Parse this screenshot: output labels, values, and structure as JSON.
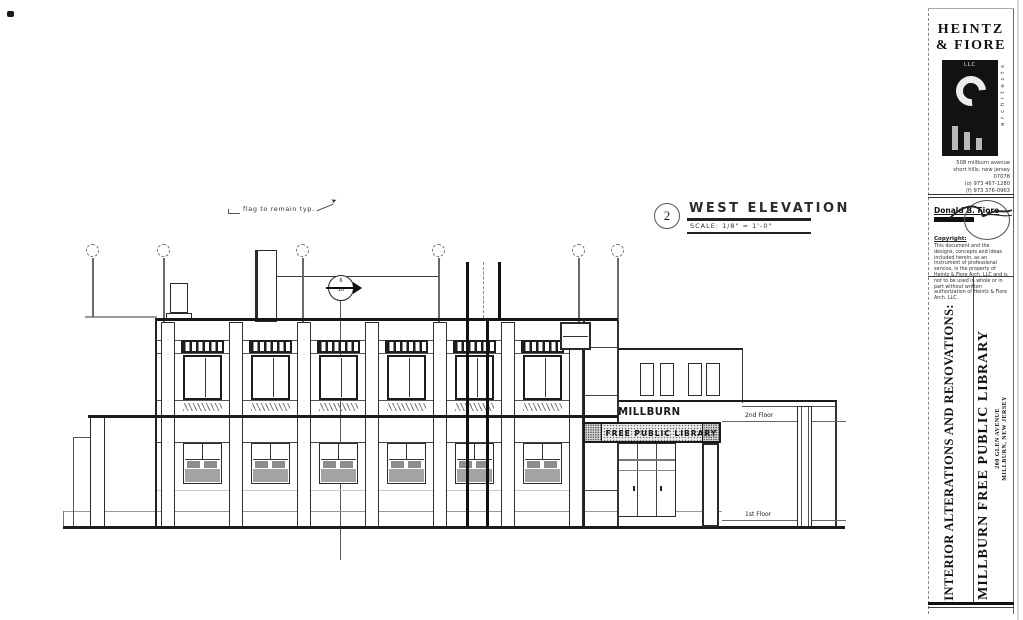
{
  "drawing": {
    "note": "flag to remain typ.",
    "title": {
      "number": "2",
      "name": "WEST ELEVATION",
      "scale": "SCALE: 1/8\" = 1'-0\""
    },
    "labels": {
      "building_name": "MILLBURN",
      "sign_band": "FREE PUBLIC LIBRARY",
      "second_floor": "2nd Floor",
      "first_floor": "1st Floor"
    },
    "section_marker": {
      "top": "6",
      "bottom": "10"
    }
  },
  "title_block": {
    "firm": {
      "name_line1": "HEINTZ",
      "name_line2": "& FIORE",
      "llc": "LLC",
      "vertical_label": "a r c h i t e c t s",
      "address": [
        "508 millburn avenue",
        "short hills, new jersey",
        "07078",
        "(o) 973 467-1280",
        "(f) 973 376-0963"
      ]
    },
    "stamp": {
      "architect": "Donald B. Fiore",
      "copyright_label": "Copyright:",
      "disclaimer": "This document and the designs, concepts and ideas included herein, as an instrument of professional service, is the property of Heintz & Fiore Arch. LLC and is not to be used in whole or in part without written authorization of Heintz & Fiore Arch. LLC."
    },
    "project": {
      "scope": "INTERIOR ALTERATIONS AND RENOVATIONS:",
      "name": "MILLBURN FREE PUBLIC LIBRARY",
      "address_line1": "200 GLEN AVENUE",
      "address_line2": "MILLBURN, NEW JERSEY"
    }
  },
  "colors": {
    "line": "#2a2a2a",
    "light_line": "#8f8f8f",
    "panel_gray": "#a3a3a3",
    "ink": "#111111"
  }
}
